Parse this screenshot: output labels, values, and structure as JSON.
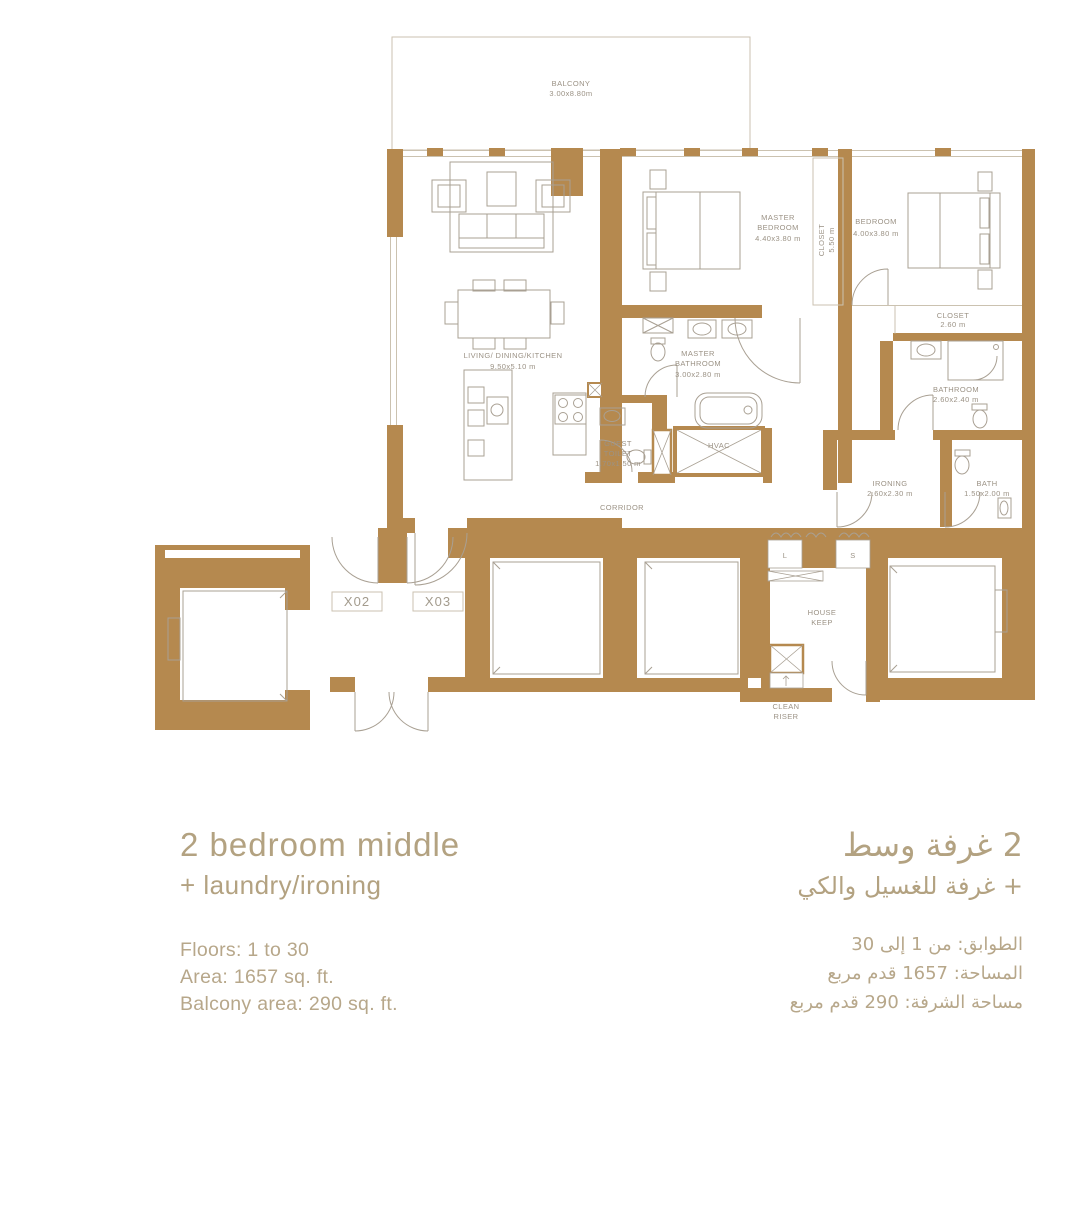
{
  "colors": {
    "wall": "#b5894f",
    "furniture_line": "#a9a093",
    "room_label": "#9b9285",
    "accent_text": "#b3a281",
    "detail_text": "#b7a78a",
    "thin_line": "#cbc2b0"
  },
  "plan": {
    "balcony": {
      "title": "BALCONY",
      "size": "3.00x8.80m"
    },
    "living": {
      "title": "LIVING/ DINING/KITCHEN",
      "size": "9.50x5.10 m"
    },
    "master_bedroom": {
      "l1": "MASTER",
      "l2": "BEDROOM",
      "size": "4.40x3.80 m"
    },
    "bedroom": {
      "title": "BEDROOM",
      "size": "4.00x3.80 m"
    },
    "master_closet": {
      "title": "CLOSET",
      "size": "5.50 m"
    },
    "bedroom_closet": {
      "title": "CLOSET",
      "size": "2.60 m"
    },
    "master_bathroom": {
      "l1": "MASTER",
      "l2": "BATHROOM",
      "size": "3.00x2.80 m"
    },
    "bathroom": {
      "title": "BATHROOM",
      "size": "2.60x2.40 m"
    },
    "guest_toilet": {
      "l1": "GUEST",
      "l2": "TOILET",
      "size": "1.70x1.50 m"
    },
    "hvac": {
      "title": "HVAC"
    },
    "corridor": {
      "title": "CORRIDOR"
    },
    "ironing": {
      "title": "IRONING",
      "size": "2.60x2.30 m"
    },
    "bath": {
      "title": "BATH",
      "size": "1.50x2.00 m"
    },
    "house_keep": {
      "l1": "HOUSE",
      "l2": "KEEP"
    },
    "clean_riser": {
      "l1": "CLEAN",
      "l2": "RISER"
    },
    "laundry_left": "L",
    "laundry_right": "S",
    "unit_left": "X02",
    "unit_right": "X03"
  },
  "info_en": {
    "title": "2 bedroom middle",
    "subtitle": "+ laundry/ironing",
    "floors": "Floors: 1 to 30",
    "area": "Area: 1657 sq. ft.",
    "balcony_area": "Balcony area: 290 sq. ft."
  },
  "info_ar": {
    "title": "2 غرفة وسط",
    "subtitle": "+ غرفة للغسيل والكي",
    "floors": "الطوابق: من 1 إلى 30",
    "area": "المساحة: 1657 قدم مربع",
    "balcony_area": "مساحة الشرفة: 290 قدم مربع"
  }
}
